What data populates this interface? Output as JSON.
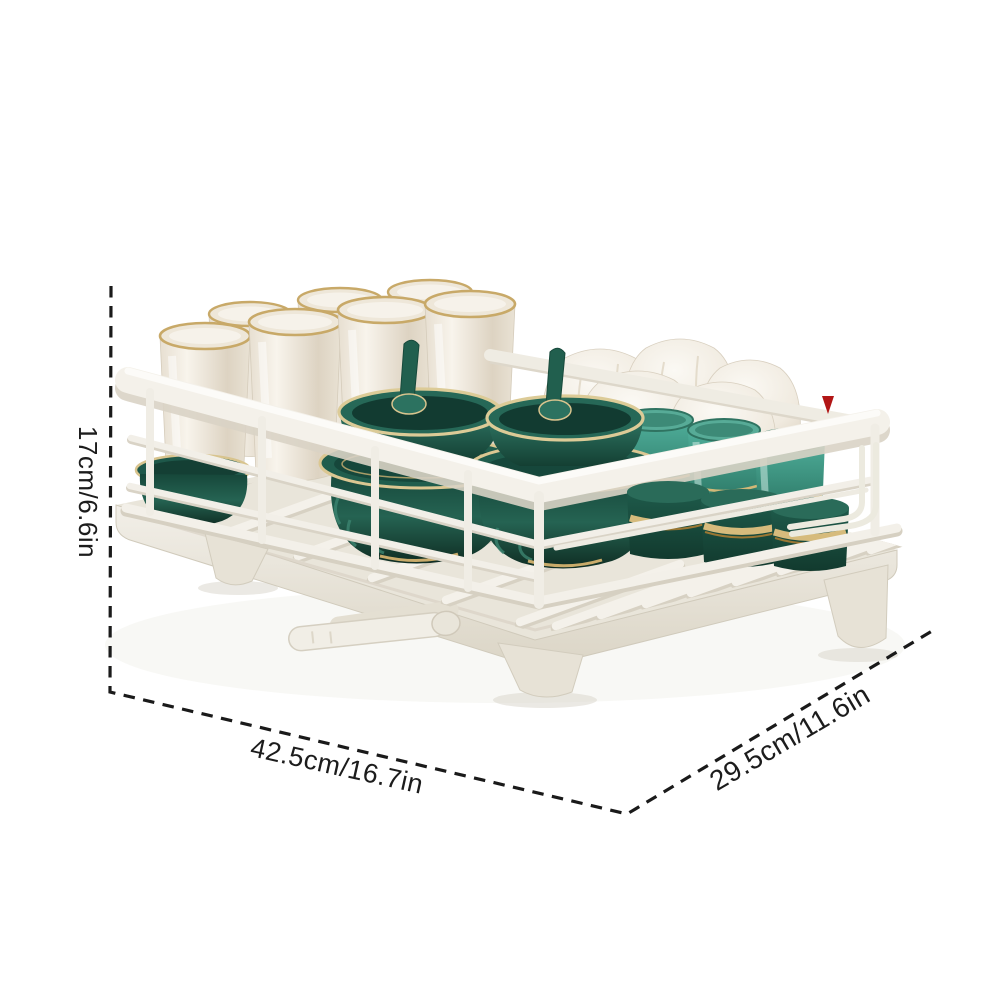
{
  "figure": {
    "description": "White kitchen dish drying rack with drainboard tray, holding cream cups, white bowls and dark green gold-trimmed bowls, cups and spoons; annotated with dotted dimension lines"
  },
  "dimensions": {
    "height": "17cm/6.6in",
    "width": "42.5cm/16.7in",
    "depth": "29.5cm/11.6in"
  },
  "marker": {
    "icon": "red-arrow-marker",
    "color": "#b21616"
  },
  "colors": {
    "background": "#ffffff",
    "dimension_line": "#1a1a1a",
    "rack_white": "#f3f0e9",
    "tray_shadow": "#d9d3c5",
    "ceramic_green_dark": "#143f33",
    "ceramic_green_mid": "#2d7361",
    "ceramic_teal": "#4fae9a",
    "gold_trim": "#cdb173",
    "cup_cream": "#efe8dc"
  }
}
